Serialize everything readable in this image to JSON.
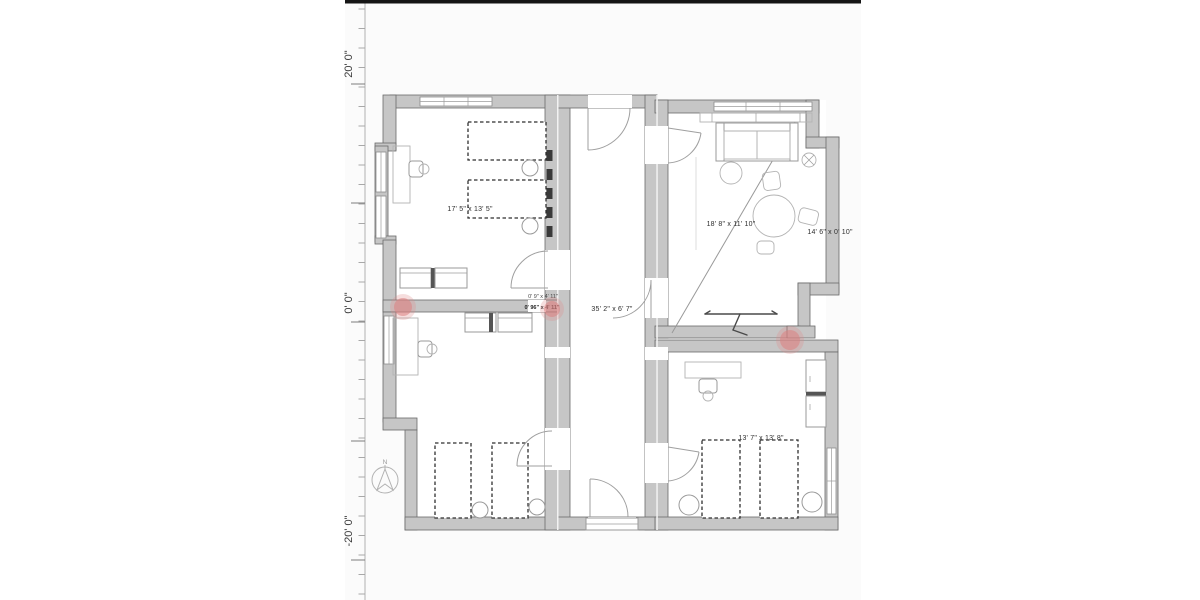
{
  "canvas": {
    "background": "#ffffff",
    "plan_background": "#fbfbfb"
  },
  "ruler": {
    "labels": [
      {
        "text": "20' 0\""
      },
      {
        "text": "0' 0\""
      },
      {
        "text": "-20' 0\""
      }
    ]
  },
  "compass": {
    "label": "N"
  },
  "rooms": {
    "bedroom_top_left": {
      "dimensions": "17' 5\" x 13' 5\""
    },
    "living_room": {
      "dimensions": "18' 8\" x 11' 10\""
    },
    "side_nook": {
      "dimensions": "14' 6\" x 0' 10\""
    },
    "corridor": {
      "dimensions": "35' 2\" x 6' 7\""
    },
    "bedroom_bottom_right": {
      "dimensions": "13' 7\" x 13' 8\""
    },
    "wall_segment_a": {
      "dimensions": "0' 9\" x 4' 11\""
    },
    "wall_segment_b": {
      "dimensions": "0' 96\" x 4' 11\""
    }
  },
  "markers": {
    "count": 3,
    "meaning": "issue-marker"
  },
  "colors": {
    "wall_fill": "#c6c6c6",
    "wall_stroke": "#6a6a6a",
    "furniture_stroke": "#9a9a9a",
    "bed_stroke": "#2f2f2f",
    "marker": "#dd7f7f",
    "ruler_bar": "#151515",
    "label_text": "#2e2e2e"
  }
}
